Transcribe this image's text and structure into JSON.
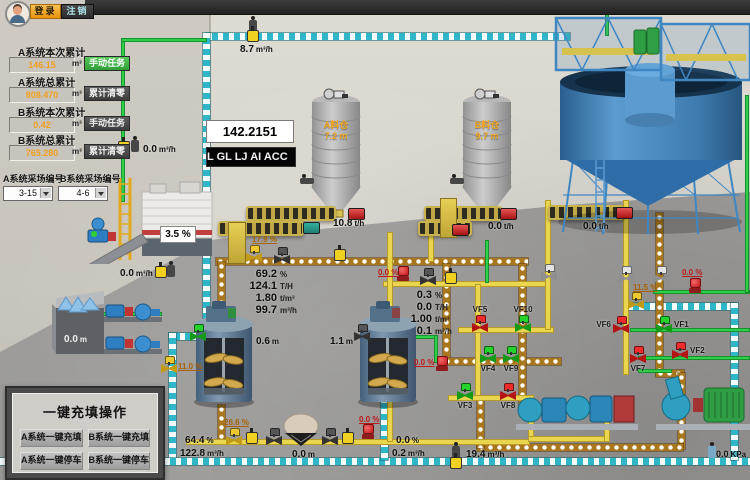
{
  "topbar": {
    "login_label": "登录",
    "logout_label": "注销"
  },
  "accumulators": {
    "a_session": {
      "label": "A系统本次累计",
      "value": "146.15",
      "unit": "m³",
      "button": "手动任务"
    },
    "a_total": {
      "label": "A系统总累计",
      "value": "808.470",
      "unit": "m³",
      "button": "累计清零"
    },
    "b_session": {
      "label": "B系统本次累计",
      "value": "0.42",
      "unit": "m³",
      "button": "手动任务"
    },
    "b_total": {
      "label": "B系统总累计",
      "value": "765.280",
      "unit": "m³",
      "button": "累计清零"
    }
  },
  "site_selectors": {
    "a_label": "A系统采场编号",
    "a_value": "3-15",
    "b_label": "B系统采场编号",
    "b_value": "4-6"
  },
  "displays": {
    "counter": "142.2151",
    "marquee": "L GL LJ AI ACC"
  },
  "silos": {
    "a": {
      "name": "A料仓",
      "level": "7.2",
      "unit": "m"
    },
    "b": {
      "name": "B料仓",
      "level": "9.7",
      "unit": "m"
    }
  },
  "readings": {
    "top_flow": {
      "v": "8.7",
      "u": "m³/h"
    },
    "left_flow": {
      "v": "0.0",
      "u": "m³/h"
    },
    "plant_pct": {
      "v": "3.5 %",
      "u": ""
    },
    "plant_flow": {
      "v": "0.0",
      "u": "m³/h"
    },
    "bin_level": {
      "v": "0.0",
      "u": "m"
    },
    "conveyor_a": {
      "v": "10.8",
      "u": "t/h"
    },
    "conveyor_mid": {
      "v": "0.0",
      "u": "t/h"
    },
    "conveyor_b": {
      "v": "0.0",
      "u": "t/h"
    },
    "tank_a_level": {
      "v": "0.6",
      "u": "m"
    },
    "tank_b_level": {
      "v": "1.1",
      "u": "m"
    },
    "line_a": [
      {
        "v": "69.2",
        "u": "%"
      },
      {
        "v": "124.1",
        "u": "T/H"
      },
      {
        "v": "1.80",
        "u": "t/m³"
      },
      {
        "v": "99.7",
        "u": "m³/h"
      }
    ],
    "line_b": [
      {
        "v": "0.3",
        "u": "%"
      },
      {
        "v": "0.0",
        "u": "T/H"
      },
      {
        "v": "1.00",
        "u": "t/m³"
      },
      {
        "v": "0.1",
        "u": "m³/h"
      }
    ],
    "bottom_a_pct": {
      "v": "64.4",
      "u": "%"
    },
    "bottom_a_flow": {
      "v": "122.8",
      "u": "m³/h"
    },
    "hopper_level": {
      "v": "0.0",
      "u": "m"
    },
    "bottom_b_pct": {
      "v": "0.0",
      "u": "%"
    },
    "bottom_b_flow": {
      "v": "0.2",
      "u": "m³/h"
    },
    "return_flow": {
      "v": "19.4",
      "u": "m³/h"
    },
    "pressure": {
      "v": "0.0",
      "u": "KPa"
    }
  },
  "pct_labels": {
    "p17_9": "17.9 %",
    "p11_0": "11.0 %",
    "p26_6": "26.6 %",
    "p11_5": "11.5 %",
    "z1": "0.0 %",
    "z2": "0.0 %",
    "z3": "0.0 %",
    "z4": "0.0 %"
  },
  "valves": [
    {
      "id": "VF1",
      "state": "open"
    },
    {
      "id": "VF2",
      "state": "closed"
    },
    {
      "id": "VF3",
      "state": "open"
    },
    {
      "id": "VF4",
      "state": "open"
    },
    {
      "id": "VF5",
      "state": "closed"
    },
    {
      "id": "VF6",
      "state": "closed"
    },
    {
      "id": "VF7",
      "state": "closed"
    },
    {
      "id": "VF8",
      "state": "closed"
    },
    {
      "id": "VF9",
      "state": "open"
    },
    {
      "id": "VF10",
      "state": "open"
    }
  ],
  "control_panel": {
    "title": "一键充填操作",
    "buttons": [
      "A系统一键充填",
      "B系统一键充填",
      "A系统一键停车",
      "B系统一键停车"
    ]
  },
  "colors": {
    "valve_open": "#24d42c",
    "valve_closed": "#ef2b2b",
    "pipe_cyan": "#2fb6c9",
    "pipe_orange": "#a9771d",
    "pipe_yellow": "#ead54e",
    "pipe_green": "#2ed04a",
    "accent_orange": "#f2a01e"
  }
}
